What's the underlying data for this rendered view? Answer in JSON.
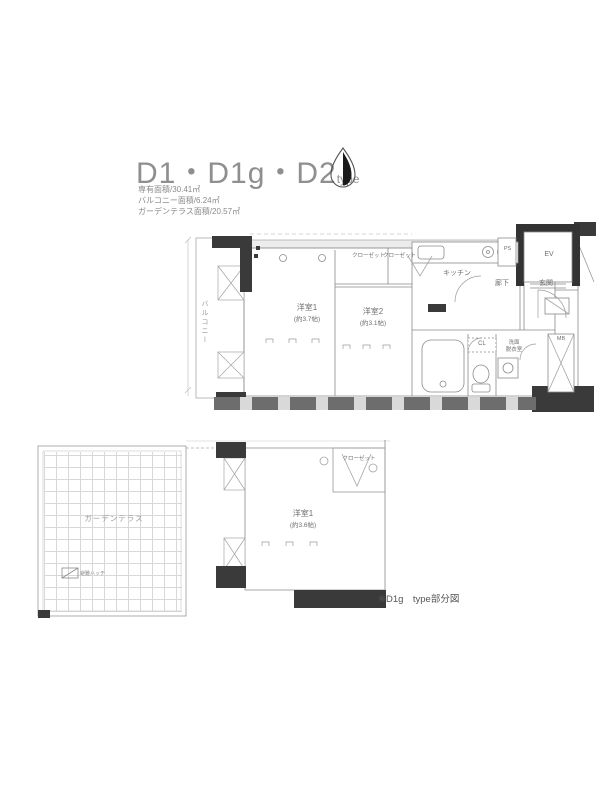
{
  "header": {
    "title": "D1・D1g・D2",
    "title_suffix": "type",
    "area_lines": {
      "l1": "専有面積/30.41㎡",
      "l2": "バルコニー面積/6.24㎡",
      "l3": "ガーデンテラス面積/20.57㎡"
    }
  },
  "main_plan": {
    "balcony_label": "バルコニー",
    "room1_label": "洋室1",
    "room1_size": "(約3.7帖)",
    "room2_label": "洋室2",
    "room2_size": "(約3.1帖)",
    "closet1_label": "クローゼット",
    "closet2_label": "クローゼット",
    "kitchen_label": "キッチン",
    "hall_label": "廊下",
    "entrance_label": "玄関",
    "elevator_label": "EV",
    "ps_label": "PS",
    "mb_label": "MB",
    "cl_label": "CL",
    "washroom_line1": "洗面",
    "washroom_line2": "脱衣室"
  },
  "sub_plan": {
    "terrace_label": "ガーデンテラス",
    "room1_label": "洋室1",
    "room1_size": "(約3.6帖)",
    "closet_label": "クローゼット",
    "hatch_label": "避難ハッチ",
    "note": "※D1g　type部分図"
  },
  "colors": {
    "line_gray": "#8a8a8a",
    "wall_dark": "#3a3a3a",
    "text_gray": "#8f8f8f"
  }
}
